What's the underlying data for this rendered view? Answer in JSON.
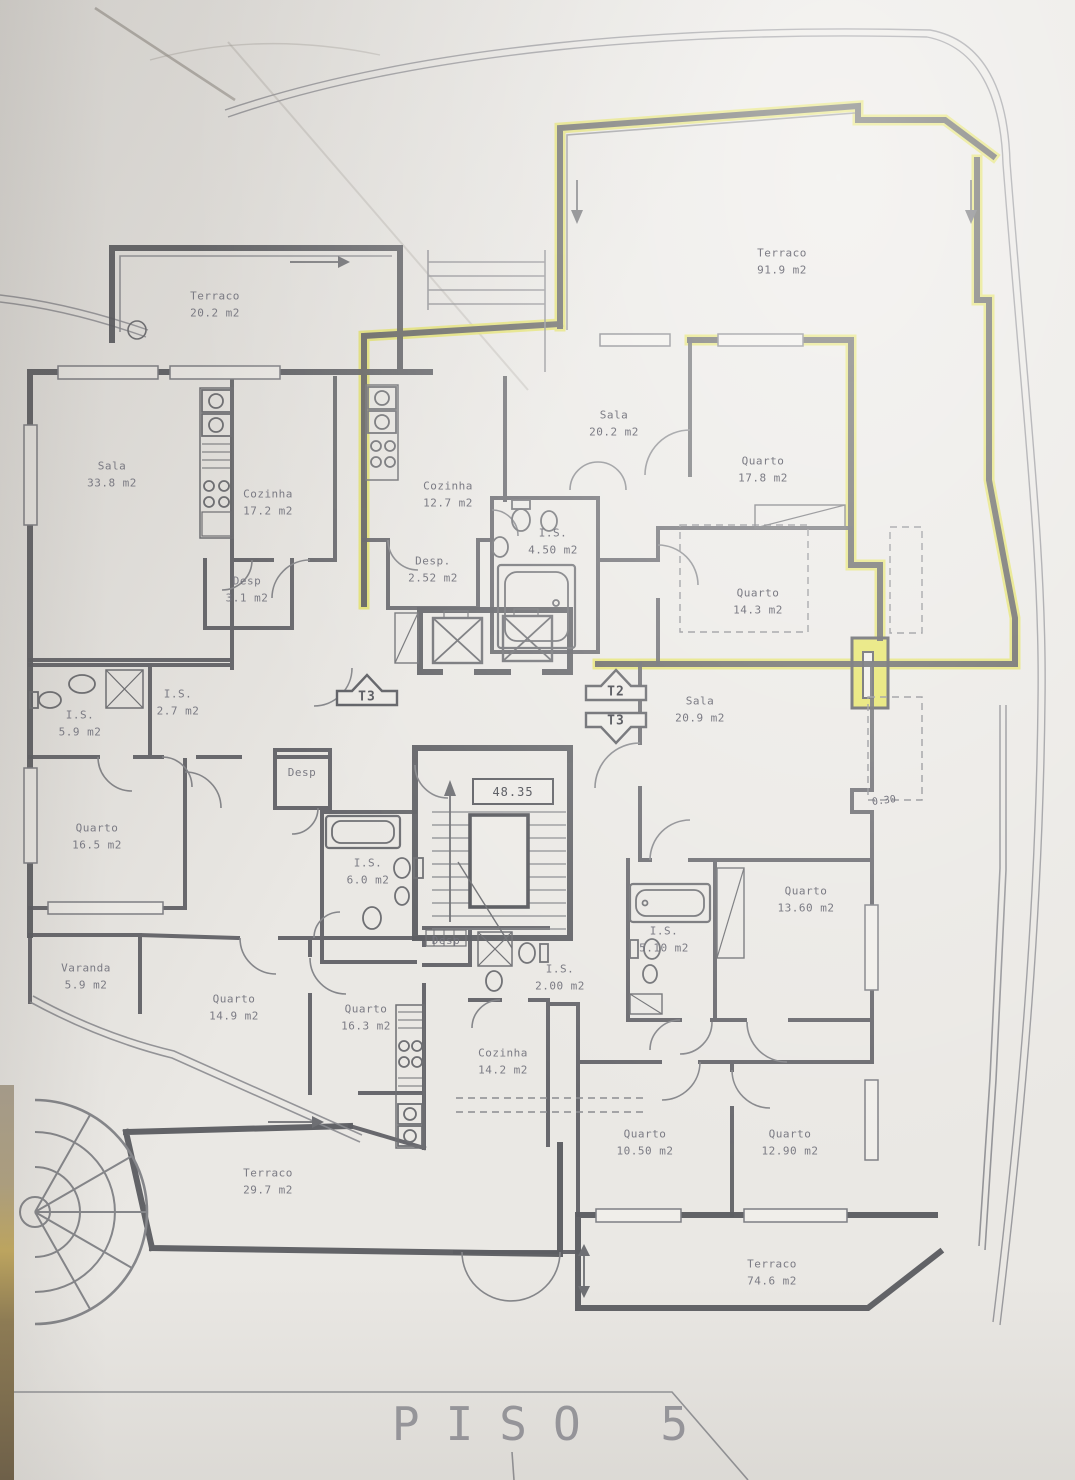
{
  "title": "PISO 5",
  "level_marker": "48.35",
  "dimension_note": "0.30",
  "stair_arrows": [
    {
      "label": "T3",
      "direction": "up"
    },
    {
      "label": "T2",
      "direction": "up"
    },
    {
      "label": "T3",
      "direction": "down"
    }
  ],
  "accent_color": "#e4e261",
  "wall_color": "#56575c",
  "rooms": [
    {
      "name": "Terraco",
      "area": "20.2 m2"
    },
    {
      "name": "Terraco",
      "area": "91.9 m2"
    },
    {
      "name": "Sala",
      "area": "33.8 m2"
    },
    {
      "name": "Cozinha",
      "area": "17.2 m2"
    },
    {
      "name": "Desp",
      "area": "3.1 m2"
    },
    {
      "name": "Cozinha",
      "area": "12.7 m2"
    },
    {
      "name": "Desp.",
      "area": "2.52 m2"
    },
    {
      "name": "I.S.",
      "area": "4.50 m2"
    },
    {
      "name": "Sala",
      "area": "20.2 m2"
    },
    {
      "name": "Quarto",
      "area": "17.8 m2"
    },
    {
      "name": "Quarto",
      "area": "14.3 m2"
    },
    {
      "name": "Sala",
      "area": "20.9 m2"
    },
    {
      "name": "I.S.",
      "area": "5.9 m2"
    },
    {
      "name": "I.S.",
      "area": "2.7 m2"
    },
    {
      "name": "Quarto",
      "area": "16.5 m2"
    },
    {
      "name": "Desp",
      "area": ""
    },
    {
      "name": "I.S.",
      "area": "6.0 m2"
    },
    {
      "name": "Desp",
      "area": ""
    },
    {
      "name": "I.S.",
      "area": "2.00 m2"
    },
    {
      "name": "Varanda",
      "area": "5.9 m2"
    },
    {
      "name": "Quarto",
      "area": "14.9 m2"
    },
    {
      "name": "Quarto",
      "area": "16.3 m2"
    },
    {
      "name": "Cozinha",
      "area": "14.2 m2"
    },
    {
      "name": "Quarto",
      "area": "13.60 m2"
    },
    {
      "name": "I.S.",
      "area": "5.10 m2"
    },
    {
      "name": "Quarto",
      "area": "10.50 m2"
    },
    {
      "name": "Quarto",
      "area": "12.90 m2"
    },
    {
      "name": "Terraco",
      "area": "29.7 m2"
    },
    {
      "name": "Terraco",
      "area": "74.6 m2"
    }
  ]
}
